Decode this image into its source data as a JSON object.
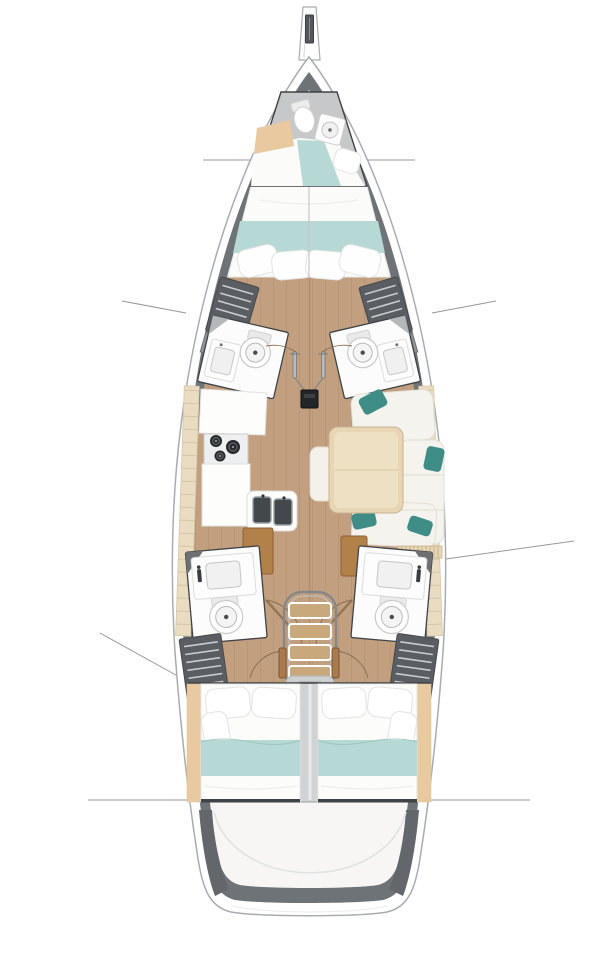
{
  "palette": {
    "bg": "#ffffff",
    "hull-stroke": "#a8acaf",
    "hull-band": "#6e7377",
    "deck-gray": "#c6c8ca",
    "interior": "#f7f6f4",
    "wood": "#c19f7f",
    "plank": "#aa8a6c",
    "ltwood": "#e9dcc0",
    "tick": "#d2c3a3",
    "tan-wood": "#e8c9a0",
    "brown": "#b28049",
    "step": "#c9a87c",
    "teal": "#b7d9d5",
    "teal-dk": "#3e8e87",
    "furn": "#fdfdfd",
    "furn-stroke": "#dcdcda",
    "outline": "#3f4346",
    "wardrobe": "#5a5e62",
    "slat": "#c9ccce",
    "line": "#97999b",
    "metal": "#84888b",
    "fitting": "#232527"
  },
  "features": [
    "bowsprit",
    "anchor-fitting",
    "hull",
    "gunwale",
    "crew-cabin",
    "crew-toilet",
    "crew-sink",
    "crew-berth",
    "owner-cabin-bed",
    "forward-wardrobe-port",
    "forward-wardrobe-starboard",
    "forward-head-port",
    "forward-head-starboard",
    "mast-post",
    "galley",
    "stove",
    "double-sink",
    "salon",
    "salon-table",
    "salon-sofa",
    "aft-head-port",
    "aft-head-starboard",
    "companionway-stairs",
    "aft-wardrobe-port",
    "aft-wardrobe-starboard",
    "aft-cabin-port",
    "aft-cabin-starboard",
    "stern-cockpit",
    "section-lines"
  ]
}
